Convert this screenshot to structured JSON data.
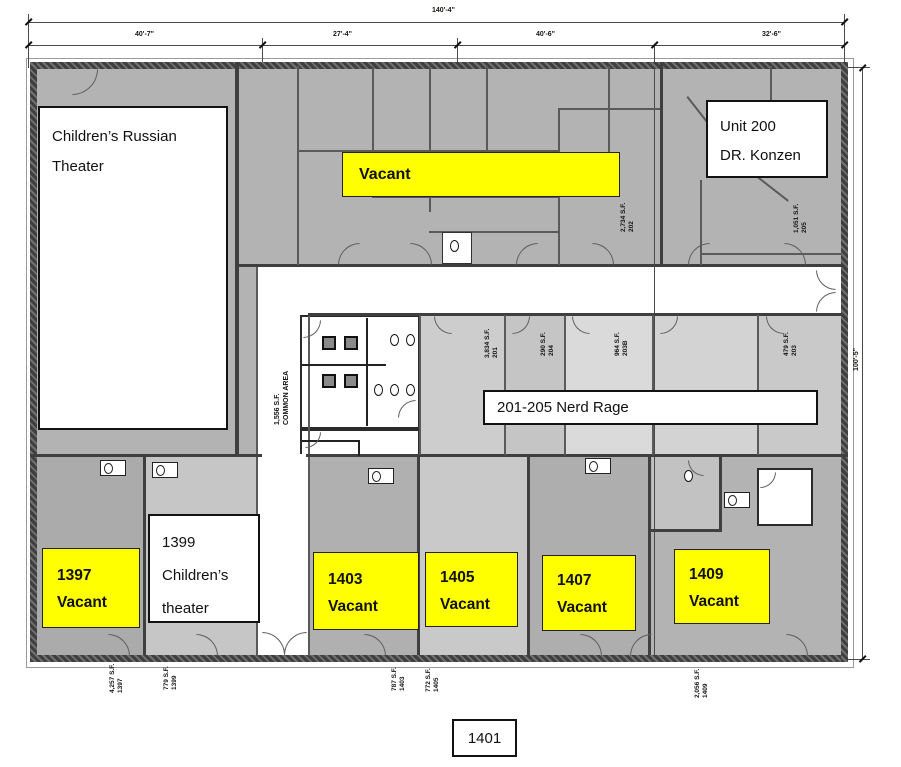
{
  "dimensions": {
    "overall": "140'-4\"",
    "seg1": "40'-7\"",
    "seg2": "27'-4\"",
    "seg3": "40'-6\"",
    "seg4": "32'-6\"",
    "right": "100'-5\""
  },
  "rooms": {
    "theater": {
      "line1": "Children’s Russian",
      "line2": "Theater"
    },
    "vacant_top": {
      "label": "Vacant"
    },
    "unit200": {
      "line1": "Unit 200",
      "line2": "DR. Konzen"
    },
    "nerd_rage": {
      "label": "201-205 Nerd Rage"
    },
    "u1399": {
      "line1": "1399",
      "line2": "Children’s",
      "line3": "theater"
    },
    "u1397": {
      "num": "1397",
      "status": "Vacant"
    },
    "u1403": {
      "num": "1403",
      "status": "Vacant"
    },
    "u1405": {
      "num": "1405",
      "status": "Vacant"
    },
    "u1407": {
      "num": "1407",
      "status": "Vacant"
    },
    "u1409": {
      "num": "1409",
      "status": "Vacant"
    },
    "u1401": {
      "num": "1401"
    }
  },
  "sf_tags": [
    {
      "unit": "202",
      "area": "2,734 S.F."
    },
    {
      "unit": "205",
      "area": "1,051 S.F."
    },
    {
      "unit": "201",
      "area": "3,834 S.F."
    },
    {
      "unit": "204",
      "area": "290 S.F."
    },
    {
      "unit": "203B",
      "area": "964 S.F."
    },
    {
      "unit": "203",
      "area": "479 S.F."
    },
    {
      "unit": "COMMON AREA",
      "area": "1,556 S.F."
    },
    {
      "unit": "1397",
      "area": "4,257 S.F."
    },
    {
      "unit": "1399",
      "area": "779 S.F."
    },
    {
      "unit": "1403",
      "area": "787 S.F."
    },
    {
      "unit": "1405",
      "area": "772 S.F."
    },
    {
      "unit": "1409",
      "area": "2,056 S.F."
    }
  ],
  "colors": {
    "highlight_yellow": "#ffff00",
    "wall_gray": "#3f3f3f",
    "room_gray": "#b3b3b3",
    "room_light": "#d2d2d2",
    "corridor_white": "#ffffff"
  }
}
